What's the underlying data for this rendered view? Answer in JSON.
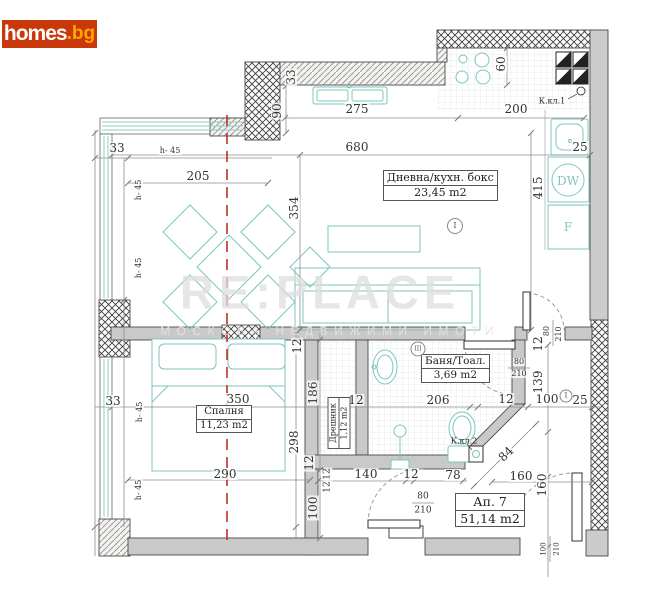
{
  "logo": {
    "brand": "homes",
    "tld": ".bg"
  },
  "watermark": {
    "title": "RE:PLACE",
    "subtitle": "МОСКОВА НЕДВИЖИМИ ИМОТИ"
  },
  "rooms": {
    "living": {
      "name": "Дневна/кухн. бокс",
      "area": "23,45 m2"
    },
    "bedroom": {
      "name": "Спалня",
      "area": "11,23 m2"
    },
    "bath": {
      "name": "Баня/Тоал.",
      "area": "3,69 m2"
    },
    "closet": {
      "name": "Дрешник",
      "area": "1,12 m2"
    },
    "apartment": {
      "name": "Ап. 7",
      "area": "51,14 m2"
    }
  },
  "appliances": {
    "dishwasher": "DW",
    "fridge": "F"
  },
  "shafts": {
    "k1": "К.кл.1",
    "k2": "К.кл.2"
  },
  "markers": {
    "living": "I",
    "bath": "III",
    "hall": "1"
  },
  "colors": {
    "logo_bg": "#c8380a",
    "logo_tld": "#ffa400",
    "furniture_teal": "#7ec5bb",
    "section_red": "#c03120",
    "wall_gray": "#c9c9c9"
  },
  "dimensions": [
    {
      "t": "275",
      "x": 357,
      "y": 109
    },
    {
      "t": "200",
      "x": 516,
      "y": 109
    },
    {
      "t": "90",
      "x": 277,
      "y": 111,
      "r": -90
    },
    {
      "t": "33",
      "x": 291,
      "y": 77,
      "r": -90
    },
    {
      "t": "60",
      "x": 501,
      "y": 64,
      "r": -90
    },
    {
      "t": "680",
      "x": 357,
      "y": 147
    },
    {
      "t": "25",
      "x": 580,
      "y": 147
    },
    {
      "t": "415",
      "x": 538,
      "y": 188,
      "r": -90
    },
    {
      "t": "354",
      "x": 294,
      "y": 208,
      "r": -90
    },
    {
      "t": "205",
      "x": 198,
      "y": 176
    },
    {
      "t": "33",
      "x": 117,
      "y": 148
    },
    {
      "t": "h- 45",
      "x": 170,
      "y": 151,
      "s": 8
    },
    {
      "t": "h- 45",
      "x": 139,
      "y": 190,
      "r": -90,
      "s": 8
    },
    {
      "t": "h- 45",
      "x": 139,
      "y": 268,
      "r": -90,
      "s": 8
    },
    {
      "t": "33",
      "x": 113,
      "y": 401
    },
    {
      "t": "h- 45",
      "x": 140,
      "y": 412,
      "r": -90,
      "s": 8
    },
    {
      "t": "h- 45",
      "x": 139,
      "y": 490,
      "r": -90,
      "s": 8
    },
    {
      "t": "350",
      "x": 238,
      "y": 399
    },
    {
      "t": "12",
      "x": 356,
      "y": 400
    },
    {
      "t": "206",
      "x": 438,
      "y": 400
    },
    {
      "t": "12",
      "x": 506,
      "y": 399
    },
    {
      "t": "100",
      "x": 547,
      "y": 399
    },
    {
      "t": "25",
      "x": 580,
      "y": 400
    },
    {
      "t": "12",
      "x": 297,
      "y": 346,
      "r": -90
    },
    {
      "t": "186",
      "x": 313,
      "y": 393,
      "r": -90
    },
    {
      "t": "298",
      "x": 294,
      "y": 442,
      "r": -90
    },
    {
      "t": "12",
      "x": 309,
      "y": 463,
      "r": -90
    },
    {
      "t": "290",
      "x": 225,
      "y": 474
    },
    {
      "t": "140",
      "x": 366,
      "y": 474
    },
    {
      "t": "12",
      "x": 411,
      "y": 474
    },
    {
      "t": "78",
      "x": 453,
      "y": 475
    },
    {
      "t": "12",
      "x": 328,
      "y": 474,
      "r": -90,
      "s": 9
    },
    {
      "t": "12",
      "x": 328,
      "y": 487,
      "r": -90,
      "s": 9
    },
    {
      "t": "100",
      "x": 313,
      "y": 508,
      "r": -90
    },
    {
      "t": "160",
      "x": 521,
      "y": 476
    },
    {
      "t": "160",
      "x": 542,
      "y": 485,
      "r": -90
    },
    {
      "t": "139",
      "x": 538,
      "y": 382,
      "r": -90
    },
    {
      "t": "12",
      "x": 538,
      "y": 344,
      "r": -90
    },
    {
      "t": "84",
      "x": 506,
      "y": 454,
      "r": -45
    },
    {
      "t": "80",
      "x": 519,
      "y": 362,
      "s": 8
    },
    {
      "t": "210",
      "x": 519,
      "y": 374,
      "s": 8
    },
    {
      "t": "80",
      "x": 423,
      "y": 497,
      "s": 9
    },
    {
      "t": "210",
      "x": 423,
      "y": 511,
      "s": 9
    },
    {
      "t": "80",
      "x": 547,
      "y": 331,
      "r": -90,
      "s": 8
    },
    {
      "t": "210",
      "x": 559,
      "y": 334,
      "r": -90,
      "s": 8
    },
    {
      "t": "100",
      "x": 544,
      "y": 549,
      "r": -90,
      "s": 7
    },
    {
      "t": "210",
      "x": 557,
      "y": 549,
      "r": -90,
      "s": 7
    }
  ]
}
